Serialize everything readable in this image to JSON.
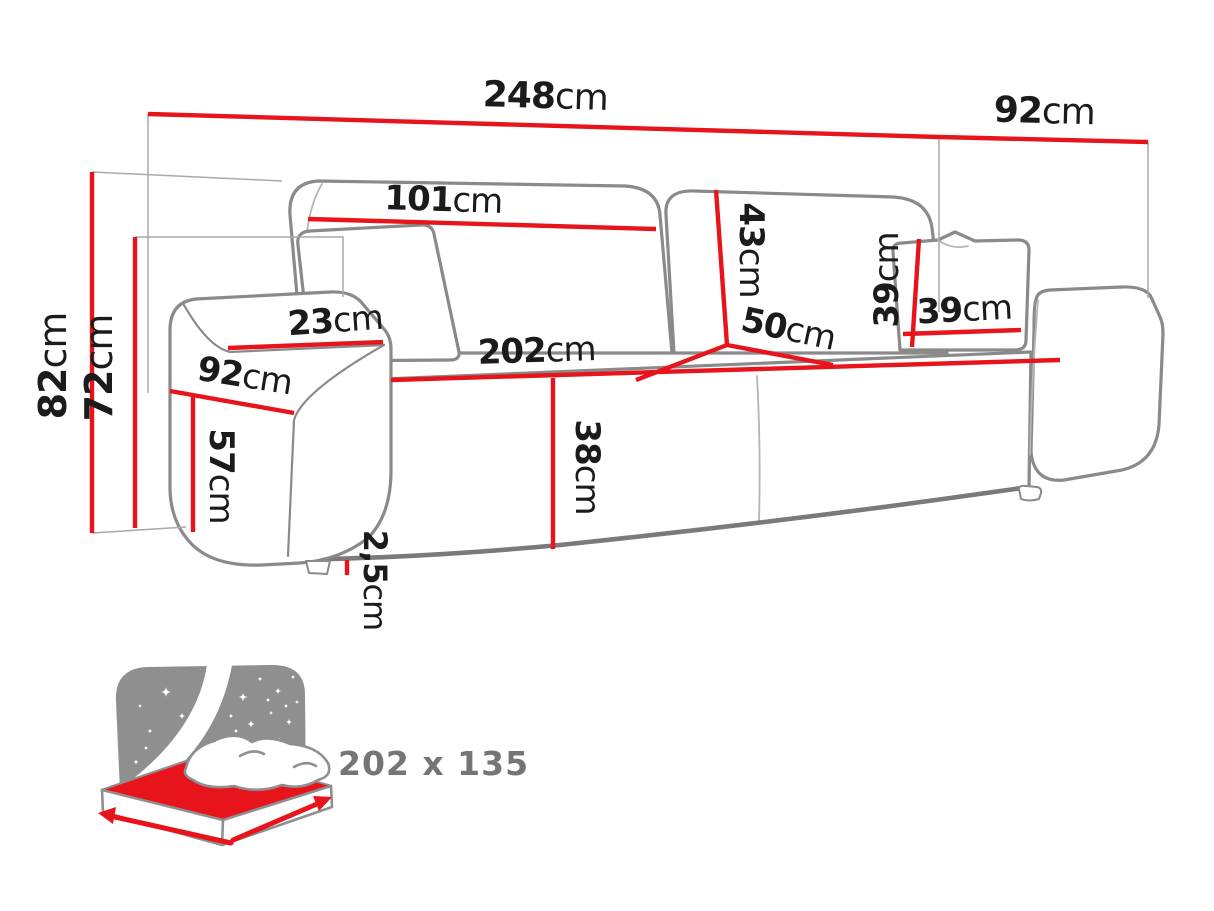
{
  "colors": {
    "dimension_red": "#e8141b",
    "outline_gray": "#8a8a8a",
    "outline_dark_gray": "#7a7a7a",
    "thin_line_gray": "#a8a8a8",
    "label_black": "#1b1b1b",
    "icon_gray": "#8f8f8f",
    "icon_text_gray": "#757575"
  },
  "unit": "cm",
  "dimensions": {
    "total_width": {
      "value": "248",
      "unit": "cm"
    },
    "total_depth": {
      "value": "92",
      "unit": "cm"
    },
    "backrest_cushion_width": {
      "value": "101",
      "unit": "cm"
    },
    "backrest_cushion_height": {
      "value": "43",
      "unit": "cm"
    },
    "total_height": {
      "value": "82",
      "unit": "cm"
    },
    "frame_height": {
      "value": "72",
      "unit": "cm"
    },
    "armrest_width": {
      "value": "23",
      "unit": "cm"
    },
    "armrest_depth": {
      "value": "92",
      "unit": "cm"
    },
    "armrest_height": {
      "value": "57",
      "unit": "cm"
    },
    "seat_width": {
      "value": "202",
      "unit": "cm"
    },
    "seat_depth": {
      "value": "50",
      "unit": "cm"
    },
    "pillow_height": {
      "value": "39",
      "unit": "cm"
    },
    "pillow_width": {
      "value": "39",
      "unit": "cm"
    },
    "seat_height": {
      "value": "38",
      "unit": "cm"
    },
    "leg_height": {
      "value": "2,5",
      "unit": "cm"
    }
  },
  "sleeping_area": {
    "size": "202 x 135"
  }
}
